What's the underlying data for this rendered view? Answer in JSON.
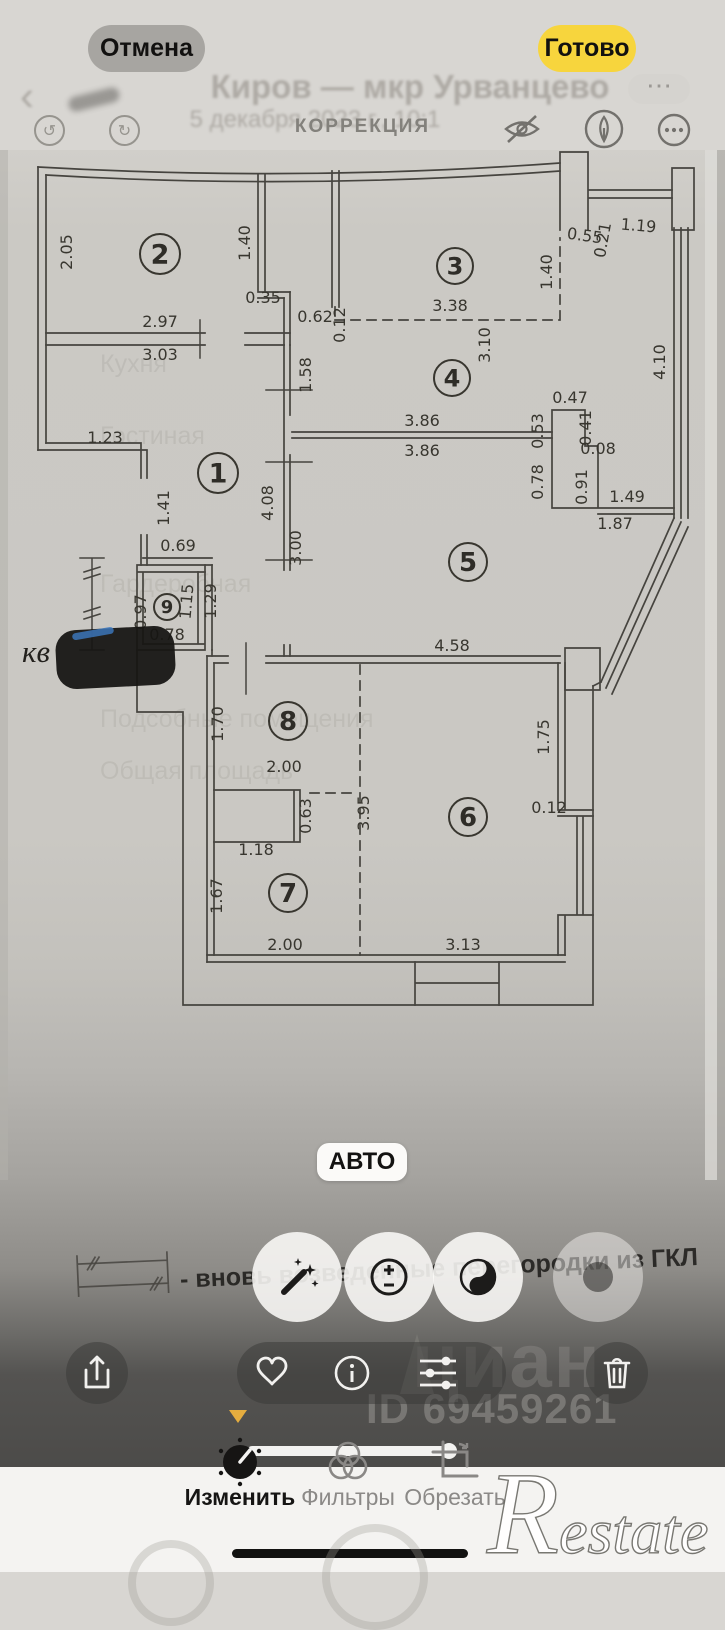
{
  "header": {
    "cancel": "Отмена",
    "done": "Готово",
    "title": "КОРРЕКЦИЯ",
    "colors": {
      "done_bg": "#f7d53d",
      "cancel_bg": "#a7a5a1",
      "accent_yellow": "#e5ad3f"
    }
  },
  "ghost": {
    "listing_title": "Киров — мкр Урванцево",
    "timestamp": "5 декабря 2023 г., 10:1",
    "back_chevron": "‹",
    "more_dots": "⋯",
    "rows": [
      {
        "t": "Кухня",
        "x": 100,
        "y": 372
      },
      {
        "t": "Гостиная",
        "x": 100,
        "y": 444
      },
      {
        "t": "Гардеробная",
        "x": 100,
        "y": 592
      },
      {
        "t": "Подсобные помещения",
        "x": 100,
        "y": 727
      },
      {
        "t": "Общая площадь",
        "x": 100,
        "y": 779
      }
    ]
  },
  "photo": {
    "kv_label": "кв",
    "auto_button": "АВТО",
    "legend": {
      "text": "- вновь возведенные перегородки из ГКЛ"
    },
    "watermark": {
      "brand": "циан",
      "id": "ID 69459261"
    },
    "plan": {
      "rooms": [
        {
          "n": "1",
          "x": 218,
          "y": 473,
          "r": 20
        },
        {
          "n": "2",
          "x": 160,
          "y": 254,
          "r": 20
        },
        {
          "n": "3",
          "x": 455,
          "y": 266,
          "r": 18
        },
        {
          "n": "4",
          "x": 452,
          "y": 378,
          "r": 18
        },
        {
          "n": "5",
          "x": 468,
          "y": 562,
          "r": 19
        },
        {
          "n": "6",
          "x": 468,
          "y": 817,
          "r": 19
        },
        {
          "n": "7",
          "x": 288,
          "y": 893,
          "r": 19
        },
        {
          "n": "8",
          "x": 288,
          "y": 721,
          "r": 19
        },
        {
          "n": "9",
          "x": 167,
          "y": 607,
          "r": 13
        }
      ],
      "dimensions": [
        {
          "t": "2.05",
          "x": 72,
          "y": 252,
          "r": -90
        },
        {
          "t": "1.40",
          "x": 250,
          "y": 243,
          "r": -90
        },
        {
          "t": "0.35",
          "x": 263,
          "y": 303
        },
        {
          "t": "2.97",
          "x": 160,
          "y": 327
        },
        {
          "t": "3.03",
          "x": 160,
          "y": 360
        },
        {
          "t": "0.62",
          "x": 315,
          "y": 322
        },
        {
          "t": "0.12",
          "x": 345,
          "y": 325,
          "r": -90
        },
        {
          "t": "1.58",
          "x": 311,
          "y": 375,
          "r": -90
        },
        {
          "t": "1.23",
          "x": 105,
          "y": 443
        },
        {
          "t": "3.38",
          "x": 450,
          "y": 311
        },
        {
          "t": "1.40",
          "x": 552,
          "y": 272,
          "r": -90
        },
        {
          "t": "0.55",
          "x": 584,
          "y": 241,
          "r": 8
        },
        {
          "t": "0.21",
          "x": 608,
          "y": 241,
          "r": -80
        },
        {
          "t": "1.19",
          "x": 638,
          "y": 231,
          "r": 5
        },
        {
          "t": "3.10",
          "x": 490,
          "y": 345,
          "r": -90
        },
        {
          "t": "4.10",
          "x": 665,
          "y": 362,
          "r": -90
        },
        {
          "t": "3.86",
          "x": 422,
          "y": 426
        },
        {
          "t": "3.86",
          "x": 422,
          "y": 456
        },
        {
          "t": "0.47",
          "x": 570,
          "y": 403
        },
        {
          "t": "0.53",
          "x": 543,
          "y": 431,
          "r": -90
        },
        {
          "t": "0.41",
          "x": 591,
          "y": 428,
          "r": -90
        },
        {
          "t": "0.08",
          "x": 598,
          "y": 454
        },
        {
          "t": "0.78",
          "x": 543,
          "y": 482,
          "r": -90
        },
        {
          "t": "0.91",
          "x": 587,
          "y": 487,
          "r": -90
        },
        {
          "t": "1.49",
          "x": 627,
          "y": 502
        },
        {
          "t": "1.87",
          "x": 615,
          "y": 529
        },
        {
          "t": "1.41",
          "x": 169,
          "y": 508,
          "r": -90
        },
        {
          "t": "4.08",
          "x": 273,
          "y": 503,
          "r": -90
        },
        {
          "t": "3.00",
          "x": 301,
          "y": 548,
          "r": -90
        },
        {
          "t": "0.69",
          "x": 178,
          "y": 551
        },
        {
          "t": "0.97",
          "x": 146,
          "y": 612,
          "r": -90
        },
        {
          "t": "1.15",
          "x": 192,
          "y": 602,
          "r": -85
        },
        {
          "t": "1.29",
          "x": 216,
          "y": 601,
          "r": -90
        },
        {
          "t": "0.78",
          "x": 167,
          "y": 640
        },
        {
          "t": "4.58",
          "x": 452,
          "y": 651
        },
        {
          "t": "1.70",
          "x": 223,
          "y": 724,
          "r": -90
        },
        {
          "t": "2.00",
          "x": 284,
          "y": 772
        },
        {
          "t": "0.63",
          "x": 311,
          "y": 816,
          "r": -90
        },
        {
          "t": "3.95",
          "x": 369,
          "y": 813,
          "r": -90
        },
        {
          "t": "1.18",
          "x": 256,
          "y": 855
        },
        {
          "t": "1.67",
          "x": 222,
          "y": 896,
          "r": -90
        },
        {
          "t": "2.00",
          "x": 285,
          "y": 950
        },
        {
          "t": "1.75",
          "x": 549,
          "y": 737,
          "r": -90
        },
        {
          "t": "0.12",
          "x": 549,
          "y": 813
        },
        {
          "t": "3.13",
          "x": 463,
          "y": 950
        }
      ]
    }
  },
  "adjust_buttons": [
    {
      "name": "auto-enhance"
    },
    {
      "name": "exposure"
    },
    {
      "name": "black-and-white"
    },
    {
      "name": "highlights"
    }
  ],
  "bottom": {
    "tabs": [
      {
        "label": "Изменить",
        "active": true
      },
      {
        "label": "Фильтры",
        "active": false
      },
      {
        "label": "Обрезать",
        "active": false
      }
    ],
    "watermark_initial": "R",
    "watermark_rest": "estate"
  }
}
